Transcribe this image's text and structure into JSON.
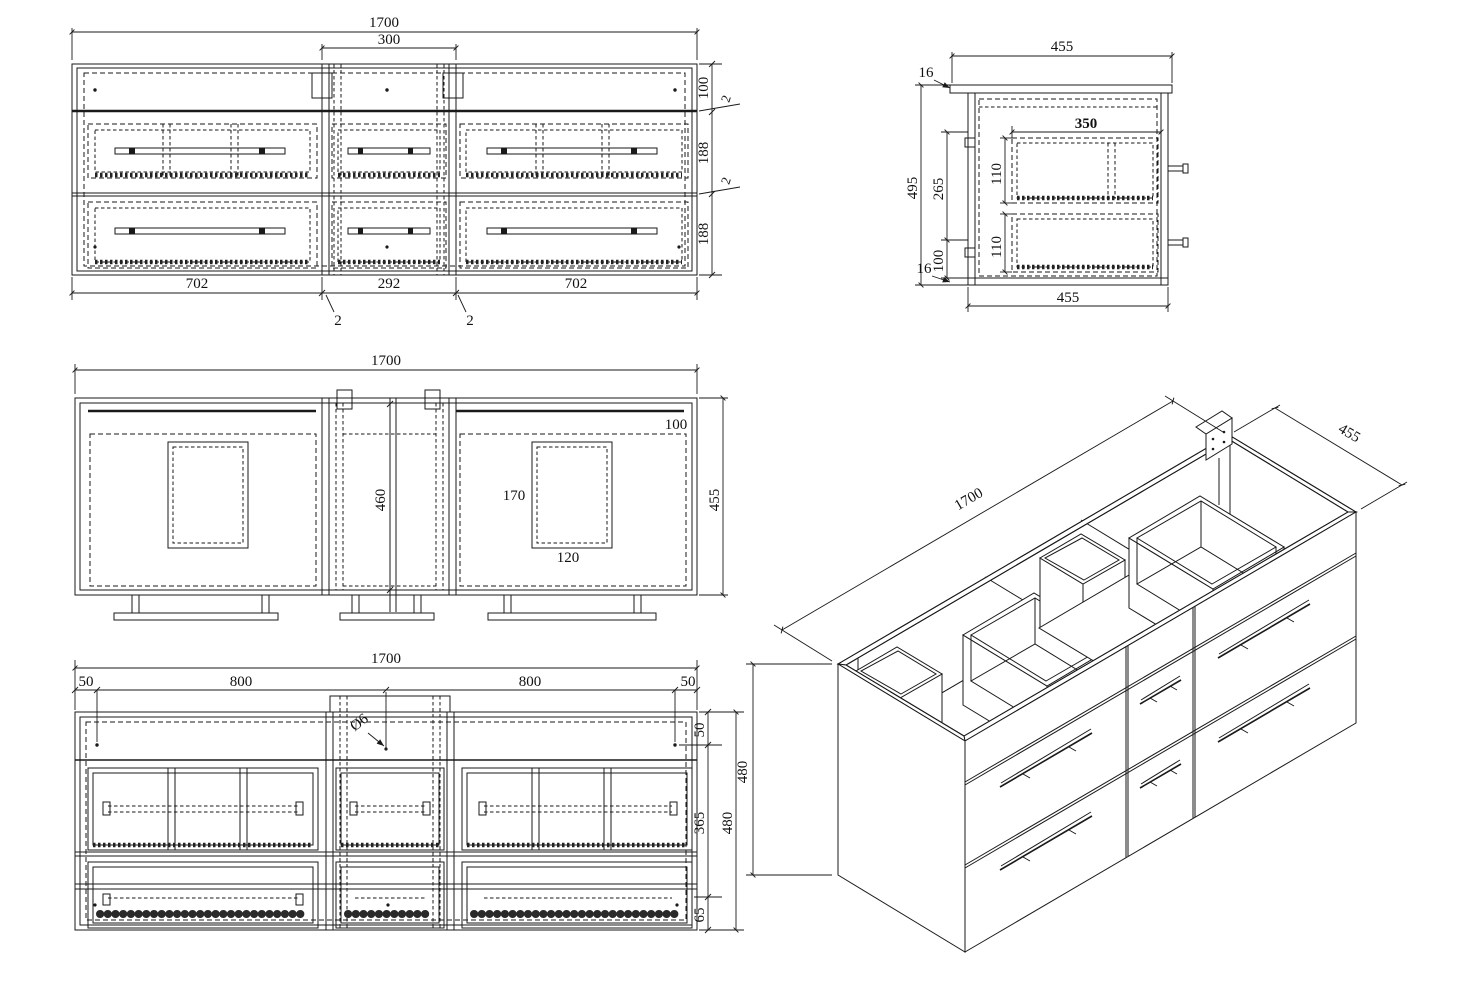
{
  "sheet": {
    "background": "#ffffff",
    "ink": "#1a1a1a"
  },
  "views": {
    "front": {
      "dim_total": "1700",
      "dim_middle": "300",
      "chain_right": [
        "100",
        "2",
        "188",
        "2",
        "188"
      ],
      "dims_bottom": [
        "702",
        "292",
        "702"
      ],
      "leaders_bottom": [
        "2",
        "2"
      ]
    },
    "side": {
      "dim_top": "455",
      "dim_bottom": "455",
      "thk_top": "16",
      "thk_bottom": "16",
      "dim_height": "495",
      "dim_upper": "265",
      "dim_lower": "100",
      "dim_inner_width": "350",
      "dim_drawer_top": "110",
      "dim_drawer_bottom": "110"
    },
    "plan": {
      "dim_total": "1700",
      "dim_depth": "455",
      "dim_back_rail": "100",
      "dim_center_section": "460",
      "dim_cutout_depth": "170",
      "dim_cutout_width": "120"
    },
    "rear": {
      "dim_total": "1700",
      "chain_top": [
        "50",
        "800",
        "800",
        "50"
      ],
      "hole_label": "Ø6",
      "chain_right": [
        "50",
        "365",
        "65"
      ],
      "dim_height": "480"
    },
    "iso": {
      "dim_length": "1700",
      "dim_depth": "455",
      "dim_height": "480"
    }
  }
}
